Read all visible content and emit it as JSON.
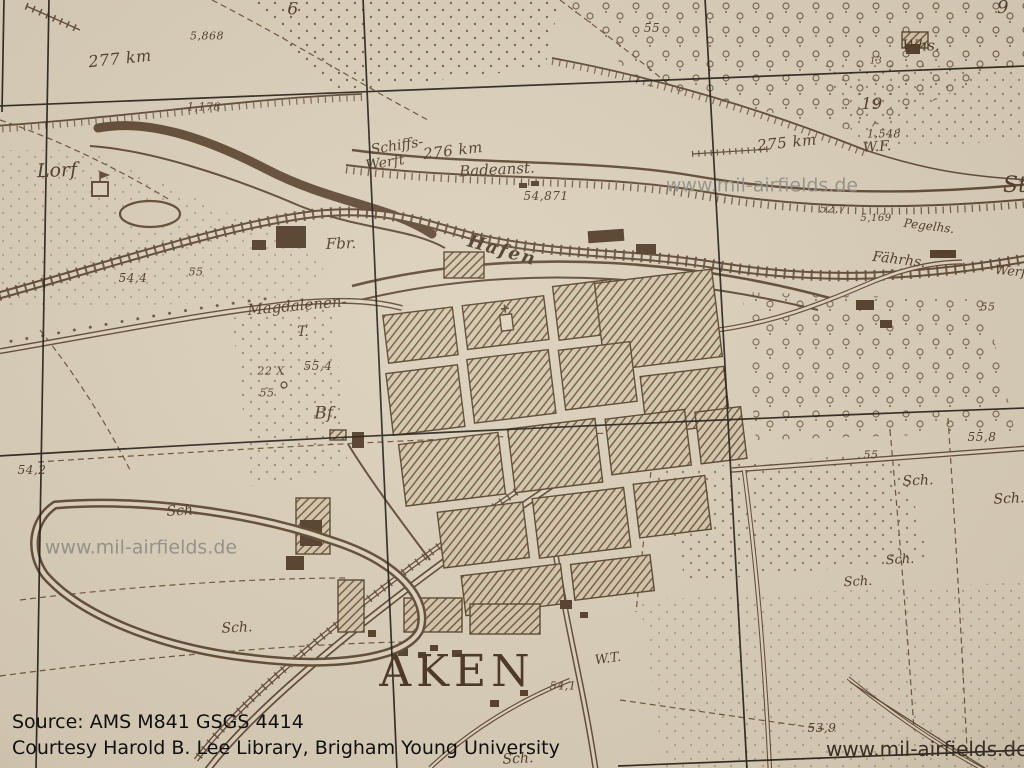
{
  "map": {
    "paper_color": "#ddd3bf",
    "ink_color": "#5d4733",
    "grid_color": "#1b1712",
    "town_name": "AKEN",
    "labels": [
      {
        "t": "AKEN",
        "x": 457,
        "y": 672,
        "s": 44,
        "rot": 0,
        "cls": "town",
        "sp": 5,
        "n": "town-name-aken"
      },
      {
        "t": "Lorf",
        "x": 57,
        "y": 171,
        "s": 19,
        "rot": -2,
        "n": "place-lorf"
      },
      {
        "t": "Schiffs-",
        "x": 397,
        "y": 146,
        "s": 14,
        "rot": -9
      },
      {
        "t": "Werft",
        "x": 385,
        "y": 163,
        "s": 14,
        "rot": -9
      },
      {
        "t": "276  km",
        "x": 453,
        "y": 151,
        "s": 15,
        "rot": -7,
        "cls": "num"
      },
      {
        "t": "Badeanst.",
        "x": 497,
        "y": 170,
        "s": 15,
        "rot": -3
      },
      {
        "t": "Hafen",
        "x": 502,
        "y": 251,
        "s": 18,
        "rot": 16,
        "cls": "fraktur",
        "n": "label-hafen"
      },
      {
        "t": "277  km",
        "x": 120,
        "y": 59,
        "s": 16,
        "rot": -6,
        "cls": "num"
      },
      {
        "t": "Fbr.",
        "x": 341,
        "y": 244,
        "s": 15,
        "rot": -2
      },
      {
        "t": "Magdalenen-",
        "x": 297,
        "y": 306,
        "s": 15,
        "rot": -5
      },
      {
        "t": "T.",
        "x": 303,
        "y": 332,
        "s": 14,
        "rot": 0
      },
      {
        "t": "Bf.",
        "x": 326,
        "y": 414,
        "s": 17,
        "rot": 0,
        "n": "label-bahnhof"
      },
      {
        "t": "W.F.",
        "x": 877,
        "y": 147,
        "s": 14,
        "rot": -4
      },
      {
        "t": "Pegelhs.",
        "x": 929,
        "y": 226,
        "s": 12,
        "rot": 7
      },
      {
        "t": "Fährhs.",
        "x": 899,
        "y": 260,
        "s": 14,
        "rot": 7
      },
      {
        "t": "Whs.",
        "x": 921,
        "y": 46,
        "s": 15,
        "rot": 0
      },
      {
        "t": "Werft",
        "x": 1013,
        "y": 272,
        "s": 13,
        "rot": 5
      },
      {
        "t": "W.T.",
        "x": 608,
        "y": 659,
        "s": 13,
        "rot": -8
      },
      {
        "t": "St",
        "x": 1015,
        "y": 186,
        "s": 22,
        "rot": 0
      },
      {
        "t": "Sch.",
        "x": 182,
        "y": 511,
        "s": 14,
        "rot": -3
      },
      {
        "t": "Sch.",
        "x": 237,
        "y": 628,
        "s": 14,
        "rot": -3
      },
      {
        "t": "Sch.",
        "x": 518,
        "y": 759,
        "s": 14,
        "rot": -3
      },
      {
        "t": "Sch.",
        "x": 858,
        "y": 582,
        "s": 13,
        "rot": -3
      },
      {
        "t": "Sch.",
        "x": 918,
        "y": 481,
        "s": 14,
        "rot": -3
      },
      {
        "t": "Sch.",
        "x": 1009,
        "y": 499,
        "s": 14,
        "rot": -3
      },
      {
        "t": "Sch.",
        "x": 900,
        "y": 560,
        "s": 13,
        "rot": -3
      },
      {
        "t": "6",
        "x": 293,
        "y": 10,
        "s": 17,
        "rot": 0,
        "cls": "num"
      },
      {
        "t": "9",
        "x": 1003,
        "y": 8,
        "s": 18,
        "rot": 0,
        "cls": "num"
      },
      {
        "t": "55",
        "x": 652,
        "y": 28,
        "s": 12,
        "rot": 0,
        "cls": "num"
      },
      {
        "t": "5,868",
        "x": 207,
        "y": 36,
        "s": 11,
        "rot": 0,
        "cls": "num"
      },
      {
        "t": "1,178",
        "x": 204,
        "y": 107,
        "s": 11,
        "rot": 0,
        "cls": "num"
      },
      {
        "t": "54,871",
        "x": 546,
        "y": 196,
        "s": 12,
        "rot": 0,
        "cls": "num"
      },
      {
        "t": "275  km",
        "x": 787,
        "y": 143,
        "s": 15,
        "rot": -6,
        "cls": "num"
      },
      {
        "t": "52,7",
        "x": 833,
        "y": 209,
        "s": 11,
        "rot": 0,
        "cls": "num"
      },
      {
        "t": "5,169",
        "x": 876,
        "y": 219,
        "s": 10,
        "rot": 0,
        "cls": "num"
      },
      {
        "t": "1,548",
        "x": 884,
        "y": 134,
        "s": 11,
        "rot": 0,
        "cls": "num"
      },
      {
        "t": "13",
        "x": 876,
        "y": 62,
        "s": 9,
        "rot": 0,
        "cls": "num"
      },
      {
        "t": "19",
        "x": 872,
        "y": 104,
        "s": 16,
        "rot": 0,
        "cls": "num"
      },
      {
        "t": "54,4",
        "x": 133,
        "y": 278,
        "s": 12,
        "rot": 0,
        "cls": "num"
      },
      {
        "t": "55",
        "x": 196,
        "y": 272,
        "s": 11,
        "rot": 0,
        "cls": "num"
      },
      {
        "t": "22 X",
        "x": 271,
        "y": 371,
        "s": 11,
        "rot": 0,
        "cls": "num"
      },
      {
        "t": "55,4",
        "x": 318,
        "y": 366,
        "s": 12,
        "rot": 0,
        "cls": "num"
      },
      {
        "t": "55",
        "x": 267,
        "y": 393,
        "s": 11,
        "rot": 0,
        "cls": "num"
      },
      {
        "t": "54,2",
        "x": 32,
        "y": 470,
        "s": 12,
        "rot": 0,
        "cls": "num"
      },
      {
        "t": "55,8",
        "x": 982,
        "y": 437,
        "s": 12,
        "rot": 0,
        "cls": "num"
      },
      {
        "t": "55",
        "x": 871,
        "y": 455,
        "s": 11,
        "rot": 0,
        "cls": "num"
      },
      {
        "t": "55",
        "x": 988,
        "y": 307,
        "s": 11,
        "rot": 0,
        "cls": "num"
      },
      {
        "t": "54,1",
        "x": 563,
        "y": 686,
        "s": 11,
        "rot": 0,
        "cls": "num"
      },
      {
        "t": "53,9",
        "x": 822,
        "y": 728,
        "s": 12,
        "rot": 0,
        "cls": "num"
      }
    ],
    "watermarks": [
      {
        "t": "www.mil-airfields.de",
        "x": 762,
        "y": 186,
        "s": 19
      },
      {
        "t": "www.mil-airfields.de",
        "x": 141,
        "y": 548,
        "s": 19
      }
    ]
  },
  "overlay": {
    "source_line": "Source: AMS M841 GSGS 4414",
    "courtesy_line": "Courtesy Harold B. Lee Library, Brigham Young University",
    "website": "www.mil-airfields.de"
  }
}
